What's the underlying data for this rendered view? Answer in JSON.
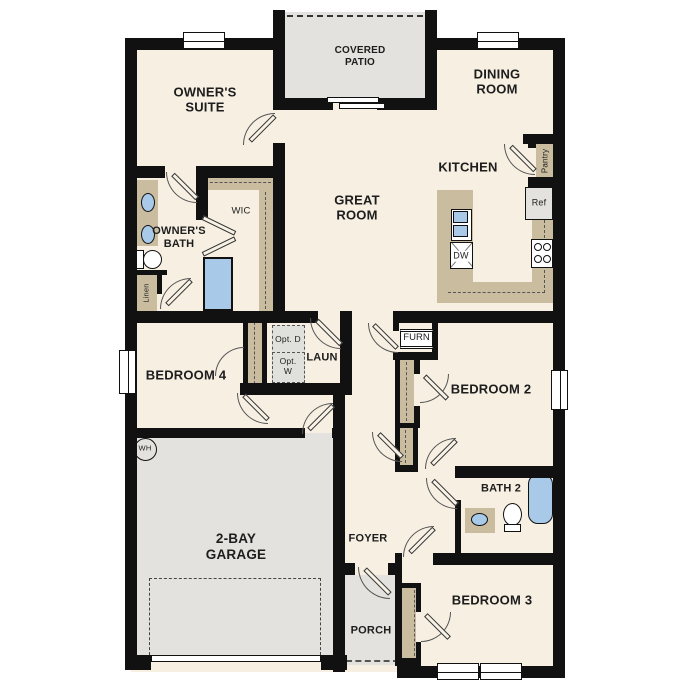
{
  "floorplan": {
    "rooms": {
      "owners_suite": "OWNER'S SUITE",
      "covered_patio": "COVERED PATIO",
      "dining_room": "DINING ROOM",
      "kitchen": "KITCHEN",
      "great_room": "GREAT ROOM",
      "owners_bath": "OWNER'S BATH",
      "wic": "WIC",
      "bedroom_4": "BEDROOM 4",
      "laundry": "LAUN",
      "bedroom_2": "BEDROOM 2",
      "bath_2": "BATH 2",
      "garage": "2-BAY GARAGE",
      "foyer": "FOYER",
      "porch": "PORCH",
      "bedroom_3": "BEDROOM 3"
    },
    "callouts": {
      "pantry": "Pantry",
      "refrigerator": "Ref",
      "dishwasher": "DW",
      "furnace": "FURN",
      "optional_dryer": "Opt. D",
      "optional_washer": "Opt. W",
      "linen": "Linen",
      "water_heater": "WH"
    },
    "colors": {
      "wall": "#111111",
      "floor": "#f6efe2",
      "outdoor": "#e3e2de",
      "casework": "#c9bc9f",
      "plumbing_fixture": "#a9c9e9"
    }
  }
}
